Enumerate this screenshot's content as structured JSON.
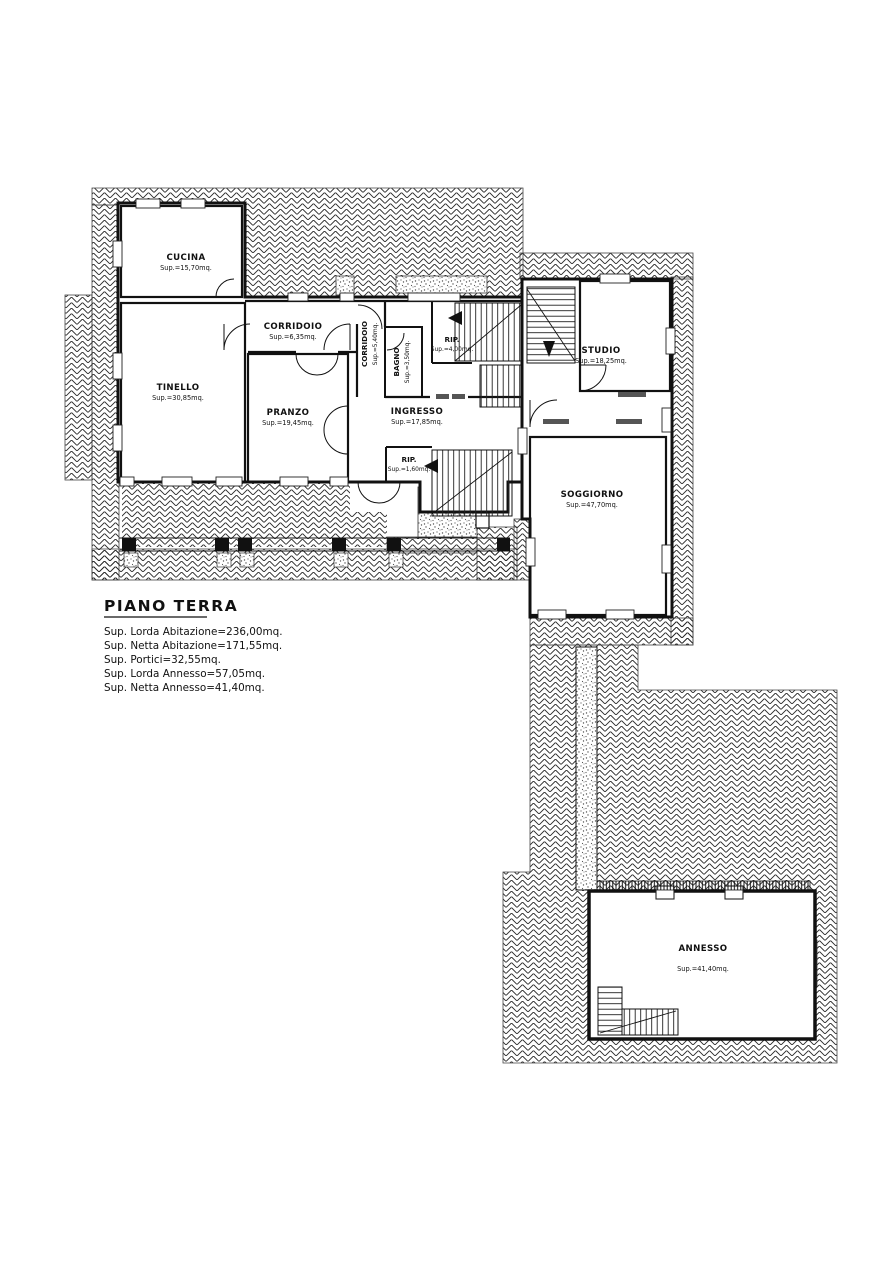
{
  "plan": {
    "title": "PIANO TERRA",
    "summary": [
      "Sup.  Lorda  Abitazione=236,00mq.",
      "Sup.  Netta  Abitazione=171,55mq.",
      "Sup.  Portici=32,55mq.",
      "Sup.  Lorda  Annesso=57,05mq.",
      "Sup.  Netta  Annesso=41,40mq."
    ],
    "rooms": [
      {
        "name": "CUCINA",
        "sup": "Sup.=15,70mq."
      },
      {
        "name": "TINELLO",
        "sup": "Sup.=30,85mq."
      },
      {
        "name": "CORRIDOIO",
        "sup": "Sup.=6,35mq."
      },
      {
        "name": "CORRIDOIO",
        "sup": "Sup.=5,40mq."
      },
      {
        "name": "BAGNO",
        "sup": "Sup.=3,50mq."
      },
      {
        "name": "RIP.",
        "sup": "Sup.=4,00mq."
      },
      {
        "name": "PRANZO",
        "sup": "Sup.=19,45mq."
      },
      {
        "name": "INGRESSO",
        "sup": "Sup.=17,85mq."
      },
      {
        "name": "RIP.",
        "sup": "Sup.=1,60mq."
      },
      {
        "name": "STUDIO",
        "sup": "Sup.=18,25mq."
      },
      {
        "name": "SOGGIORNO",
        "sup": "Sup.=47,70mq."
      },
      {
        "name": "ANNESSO",
        "sup": "Sup.=41,40mq."
      }
    ],
    "colors": {
      "paper": "#ffffff",
      "ink": "#111111",
      "hatch_line": "#2b2b2b",
      "stipple": "#555555"
    }
  }
}
